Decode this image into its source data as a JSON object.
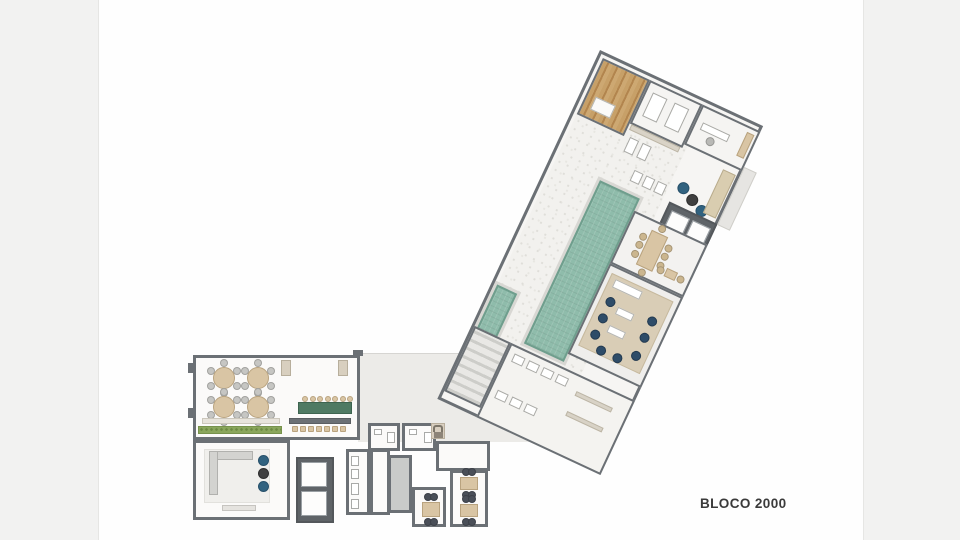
{
  "label": {
    "text": "BLOCO 2000"
  },
  "palette": {
    "wall": "#6b7075",
    "wall_dark": "#5f6468",
    "floor": "#fbfaf9",
    "floor_gray": "#ecebe8",
    "deck": "#f2f1ee",
    "pool": "#8fbcab",
    "pool_edge": "#6f9e8d",
    "wood_deck": "#c7a068",
    "furniture_beige": "#d9c5a4",
    "communal_table_green": "#4f7a63",
    "hedge_green": "#8aa65c",
    "navy_chair": "#2e4c68",
    "pouf_blue": "#31627f",
    "tree_green": "#4c7d46",
    "rug_tan": "#d9cdb6"
  },
  "furniture": [
    {
      "kind": "round-table",
      "parent": "party-room",
      "name": "dining-table-round",
      "cx": 28,
      "cy": 20,
      "r": 11,
      "chairs": 6
    },
    {
      "kind": "round-table",
      "parent": "party-room",
      "name": "dining-table-round",
      "cx": 62,
      "cy": 20,
      "r": 11,
      "chairs": 6
    },
    {
      "kind": "round-table",
      "parent": "party-room",
      "name": "dining-table-round",
      "cx": 28,
      "cy": 49,
      "r": 11,
      "chairs": 6
    },
    {
      "kind": "round-table",
      "parent": "party-room",
      "name": "dining-table-round",
      "cx": 62,
      "cy": 49,
      "r": 11,
      "chairs": 6
    },
    {
      "kind": "box",
      "parent": "party-room",
      "name": "bench",
      "x": 85,
      "y": 2,
      "w": 10,
      "h": 16,
      "fill": "#d8cfbf",
      "stroke": "#b7ae9c"
    },
    {
      "kind": "box",
      "parent": "party-room",
      "name": "bench",
      "x": 142,
      "y": 2,
      "w": 10,
      "h": 16,
      "fill": "#d8cfbf",
      "stroke": "#b7ae9c"
    },
    {
      "kind": "box",
      "parent": "party-room",
      "name": "bench-row",
      "x": 6,
      "y": 60,
      "w": 78,
      "h": 6,
      "fill": "#e8e4dc",
      "stroke": "#ccc7bc"
    },
    {
      "kind": "hedge",
      "parent": "party-room",
      "name": "planter-hedge",
      "x": 2,
      "y": 68,
      "w": 84,
      "h": 8
    },
    {
      "kind": "box",
      "parent": "party-room",
      "name": "communal-table",
      "x": 102,
      "y": 44,
      "w": 54,
      "h": 12,
      "fill": "#4f7a63",
      "stroke": "#3e6450"
    },
    {
      "kind": "row",
      "parent": "party-room",
      "name": "stool",
      "shape": "circle",
      "x": 106,
      "y": 38,
      "dx": 7.5,
      "dy": 0,
      "n": 7,
      "size": 6,
      "fill": "#d9c5a4",
      "stroke": "#b9a37f"
    },
    {
      "kind": "box",
      "parent": "party-room",
      "name": "bar-counter",
      "x": 93,
      "y": 60,
      "w": 62,
      "h": 6,
      "fill": "#6b7075",
      "stroke": "#5a5e62"
    },
    {
      "kind": "row",
      "parent": "party-room",
      "name": "bar-stool",
      "shape": "square",
      "x": 96,
      "y": 68,
      "dx": 8,
      "dy": 0,
      "n": 7,
      "size": 6,
      "fill": "#d9c5a4",
      "stroke": "#b9a37f"
    },
    {
      "kind": "box",
      "parent": "lounge-room",
      "name": "rug",
      "x": 8,
      "y": 6,
      "w": 66,
      "h": 54,
      "fill": "#f0efec",
      "stroke": "#e2e1dd"
    },
    {
      "kind": "box",
      "parent": "lounge-room",
      "name": "sofa",
      "x": 13,
      "y": 8,
      "w": 44,
      "h": 9,
      "fill": "#d3d3d0",
      "stroke": "#b1b1ae"
    },
    {
      "kind": "box",
      "parent": "lounge-room",
      "name": "sofa",
      "x": 13,
      "y": 8,
      "w": 9,
      "h": 44,
      "fill": "#d3d3d0",
      "stroke": "#b1b1ae"
    },
    {
      "kind": "circle",
      "parent": "lounge-room",
      "name": "pouf",
      "x": 62,
      "y": 12,
      "w": 11,
      "h": 11,
      "fill": "#31627f",
      "stroke": "#27506a"
    },
    {
      "kind": "circle",
      "parent": "lounge-room",
      "name": "pouf",
      "x": 62,
      "y": 25,
      "w": 11,
      "h": 11,
      "fill": "#3f3f3f",
      "stroke": "#2e2e2e"
    },
    {
      "kind": "circle",
      "parent": "lounge-room",
      "name": "pouf",
      "x": 62,
      "y": 38,
      "w": 11,
      "h": 11,
      "fill": "#31627f",
      "stroke": "#27506a"
    },
    {
      "kind": "box",
      "parent": "lounge-room",
      "name": "tv-console",
      "x": 26,
      "y": 62,
      "w": 34,
      "h": 6,
      "fill": "#e5e3df",
      "stroke": "#c6c4c0"
    },
    {
      "kind": "box",
      "parent": "elevator-a",
      "name": "elevator-car",
      "x": 3,
      "y": 3,
      "w": 26,
      "h": 25,
      "fill": "#fdfdfc",
      "stroke": "#9aa0a4"
    },
    {
      "kind": "box",
      "parent": "elevator-a",
      "name": "elevator-car",
      "x": 3,
      "y": 32,
      "w": 26,
      "h": 25,
      "fill": "#fdfdfc",
      "stroke": "#9aa0a4"
    },
    {
      "kind": "box",
      "parent": "kitchen",
      "name": "appliance",
      "x": 2,
      "y": 4,
      "w": 8,
      "h": 10,
      "fill": "#ffffff",
      "stroke": "#a9aaa8"
    },
    {
      "kind": "box",
      "parent": "kitchen",
      "name": "appliance",
      "x": 2,
      "y": 17,
      "w": 8,
      "h": 10,
      "fill": "#ffffff",
      "stroke": "#a9aaa8"
    },
    {
      "kind": "box",
      "parent": "kitchen",
      "name": "sink",
      "x": 2,
      "y": 31,
      "w": 8,
      "h": 12,
      "fill": "#ffffff",
      "stroke": "#a9aaa8"
    },
    {
      "kind": "box",
      "parent": "kitchen",
      "name": "stove",
      "x": 2,
      "y": 47,
      "w": 8,
      "h": 10,
      "fill": "#ffffff",
      "stroke": "#a9aaa8"
    },
    {
      "kind": "box",
      "parent": "wc-1",
      "name": "sink",
      "x": 3,
      "y": 3,
      "w": 8,
      "h": 6,
      "fill": "#ffffff",
      "stroke": "#a9aaa8"
    },
    {
      "kind": "box",
      "parent": "wc-1",
      "name": "toilet",
      "x": 16,
      "y": 6,
      "w": 8,
      "h": 11,
      "fill": "#ffffff",
      "stroke": "#a9aaa8"
    },
    {
      "kind": "box",
      "parent": "wc-2",
      "name": "sink",
      "x": 4,
      "y": 3,
      "w": 8,
      "h": 6,
      "fill": "#ffffff",
      "stroke": "#a9aaa8"
    },
    {
      "kind": "box",
      "parent": "wc-2",
      "name": "toilet",
      "x": 19,
      "y": 6,
      "w": 8,
      "h": 11,
      "fill": "#ffffff",
      "stroke": "#a9aaa8"
    },
    {
      "kind": "rect-table",
      "parent": "breakfast-room",
      "name": "breakfast-table",
      "x": 7,
      "y": 12,
      "w": 18,
      "h": 15,
      "fill": "#d9c5a4",
      "stroke": "#b9a37f",
      "sides": {
        "t": 2,
        "b": 2
      },
      "chairFill": "#4a4f58"
    },
    {
      "kind": "rect-table",
      "parent": "games-room",
      "name": "games-table",
      "x": 7,
      "y": 4,
      "w": 18,
      "h": 13,
      "fill": "#d9c5a4",
      "stroke": "#b9a37f",
      "sides": {
        "t": 2,
        "b": 2
      },
      "chairFill": "#4a4f58"
    },
    {
      "kind": "rect-table",
      "parent": "games-room",
      "name": "games-table",
      "x": 7,
      "y": 31,
      "w": 18,
      "h": 13,
      "fill": "#d9c5a4",
      "stroke": "#b9a37f",
      "sides": {
        "t": 2,
        "b": 2
      },
      "chairFill": "#4a4f58"
    },
    {
      "kind": "box",
      "parent": "sauna-room",
      "name": "sauna-bench",
      "x": 8,
      "y": 36,
      "w": 22,
      "h": 14,
      "fill": "#fbfaf8",
      "stroke": "#b5b5b0"
    },
    {
      "kind": "box",
      "parent": "massage-room",
      "name": "massage-bed",
      "x": 6,
      "y": 8,
      "w": 16,
      "h": 26,
      "fill": "#ffffff",
      "stroke": "#a9a9a5"
    },
    {
      "kind": "box",
      "parent": "massage-room",
      "name": "massage-bed",
      "x": 30,
      "y": 8,
      "w": 16,
      "h": 26,
      "fill": "#ffffff",
      "stroke": "#a9a9a5"
    },
    {
      "kind": "box",
      "parent": "office",
      "name": "desk",
      "x": 6,
      "y": 14,
      "w": 30,
      "h": 8,
      "fill": "#ffffff",
      "stroke": "#a9a9a5"
    },
    {
      "kind": "circle",
      "parent": "office",
      "name": "office-chair",
      "x": 16,
      "y": 24,
      "w": 9,
      "h": 9,
      "fill": "#b9b9b6",
      "stroke": "#989895"
    },
    {
      "kind": "box",
      "parent": "office",
      "name": "sideboard",
      "x": 50,
      "y": 4,
      "w": 8,
      "h": 26,
      "fill": "#d9c5a4",
      "stroke": "#b9a37f"
    },
    {
      "kind": "box",
      "parent": "lobby",
      "name": "shelf",
      "x": 2,
      "y": 0,
      "w": 54,
      "h": 6,
      "fill": "#d9d3c7",
      "stroke": "#bcb5a5"
    },
    {
      "kind": "box",
      "parent": "lobby",
      "name": "gym-equipment",
      "x": 6,
      "y": 12,
      "w": 10,
      "h": 16,
      "fill": "#ffffff",
      "stroke": "#a9a9a5"
    },
    {
      "kind": "box",
      "parent": "lobby",
      "name": "gym-equipment",
      "x": 20,
      "y": 12,
      "w": 10,
      "h": 16,
      "fill": "#ffffff",
      "stroke": "#a9a9a5"
    },
    {
      "kind": "box",
      "parent": "lobby",
      "name": "gym-equipment",
      "x": 24,
      "y": 40,
      "w": 10,
      "h": 12,
      "fill": "#ffffff",
      "stroke": "#a9a9a5"
    },
    {
      "kind": "box",
      "parent": "lobby",
      "name": "gym-equipment",
      "x": 37,
      "y": 40,
      "w": 10,
      "h": 12,
      "fill": "#ffffff",
      "stroke": "#a9a9a5"
    },
    {
      "kind": "box",
      "parent": "lobby",
      "name": "gym-equipment",
      "x": 50,
      "y": 40,
      "w": 10,
      "h": 12,
      "fill": "#ffffff",
      "stroke": "#a9a9a5"
    },
    {
      "kind": "circle",
      "parent": "lobby",
      "name": "pouf",
      "x": 70,
      "y": 30,
      "w": 12,
      "h": 12,
      "fill": "#31627f",
      "stroke": "#27506a"
    },
    {
      "kind": "circle",
      "parent": "lobby",
      "name": "pouf",
      "x": 83,
      "y": 37,
      "w": 12,
      "h": 12,
      "fill": "#3f3f3f",
      "stroke": "#2e2e2e"
    },
    {
      "kind": "circle",
      "parent": "lobby",
      "name": "pouf",
      "x": 96,
      "y": 43,
      "w": 12,
      "h": 12,
      "fill": "#31627f",
      "stroke": "#27506a"
    },
    {
      "kind": "box",
      "parent": "lobby",
      "name": "planter-bench",
      "x": 104,
      "y": 2,
      "w": 14,
      "h": 48,
      "fill": "#d9cdb0",
      "stroke": "#b8ab8c"
    },
    {
      "kind": "box",
      "parent": "elevator-b",
      "name": "elevator-car",
      "x": 4,
      "y": 5,
      "w": 20,
      "h": 46,
      "fill": "#fdfdfc",
      "stroke": "#9aa0a4"
    },
    {
      "kind": "box",
      "parent": "elevator-b",
      "name": "elevator-car",
      "x": 27,
      "y": 5,
      "w": 20,
      "h": 46,
      "fill": "#fdfdfc",
      "stroke": "#9aa0a4"
    },
    {
      "kind": "box",
      "parent": "deck",
      "name": "sun-lounger",
      "x": 4,
      "y": 18,
      "w": 26,
      "h": 16,
      "fill": "#fdfdfc",
      "stroke": "#b5b5b1"
    },
    {
      "kind": "box",
      "parent": "deck",
      "name": "sun-lounger",
      "x": 4,
      "y": 40,
      "w": 26,
      "h": 16,
      "fill": "#fdfdfc",
      "stroke": "#b5b5b1"
    },
    {
      "kind": "box",
      "parent": "deck",
      "name": "sun-lounger",
      "x": 4,
      "y": 62,
      "w": 26,
      "h": 16,
      "fill": "#fdfdfc",
      "stroke": "#b5b5b1"
    },
    {
      "kind": "box",
      "parent": "deck",
      "name": "sun-lounger",
      "x": 4,
      "y": 84,
      "w": 26,
      "h": 16,
      "fill": "#fdfdfc",
      "stroke": "#b5b5b1"
    },
    {
      "kind": "box",
      "parent": "deck",
      "name": "sun-lounger",
      "x": 4,
      "y": 132,
      "w": 26,
      "h": 16,
      "fill": "#fdfdfc",
      "stroke": "#b5b5b1"
    },
    {
      "kind": "box",
      "parent": "deck",
      "name": "sun-lounger",
      "x": 4,
      "y": 154,
      "w": 26,
      "h": 16,
      "fill": "#fdfdfc",
      "stroke": "#b5b5b1"
    },
    {
      "kind": "box",
      "parent": "deck",
      "name": "sun-lounger",
      "x": 4,
      "y": 176,
      "w": 26,
      "h": 16,
      "fill": "#fdfdfc",
      "stroke": "#b5b5b1"
    },
    {
      "kind": "box",
      "parent": "deck",
      "name": "sun-lounger",
      "x": 4,
      "y": 198,
      "w": 26,
      "h": 16,
      "fill": "#fdfdfc",
      "stroke": "#b5b5b1"
    },
    {
      "kind": "box",
      "parent": "deck",
      "name": "side-table",
      "x": 32,
      "y": 26,
      "w": 6,
      "h": 6,
      "fill": "#5a5e62",
      "stroke": "#4a4e52"
    },
    {
      "kind": "box",
      "parent": "deck",
      "name": "side-table",
      "x": 32,
      "y": 70,
      "w": 6,
      "h": 6,
      "fill": "#5a5e62",
      "stroke": "#4a4e52"
    },
    {
      "kind": "box",
      "parent": "deck",
      "name": "side-table",
      "x": 32,
      "y": 140,
      "w": 6,
      "h": 6,
      "fill": "#5a5e62",
      "stroke": "#4a4e52"
    },
    {
      "kind": "box",
      "parent": "deck",
      "name": "side-table",
      "x": 32,
      "y": 184,
      "w": 6,
      "h": 6,
      "fill": "#5a5e62",
      "stroke": "#4a4e52"
    },
    {
      "kind": "tree",
      "parent": "deck",
      "name": "tree-icon",
      "x": 15,
      "y": 123,
      "w": 18
    },
    {
      "kind": "tree",
      "parent": "deck",
      "name": "tree-icon",
      "x": 7,
      "y": 186,
      "w": 18
    },
    {
      "kind": "rect-table",
      "parent": "dining-room",
      "name": "dining-table-long",
      "x": 22,
      "y": 8,
      "w": 18,
      "h": 38,
      "fill": "#d9c5a4",
      "stroke": "#b9a37f",
      "sides": {
        "l": 3,
        "r": 3,
        "t": 1,
        "b": 1
      },
      "chairFill": "#cbb68f"
    },
    {
      "kind": "rect-table",
      "parent": "dining-room",
      "name": "cafe-table",
      "x": 52,
      "y": 36,
      "w": 12,
      "h": 9,
      "fill": "#d9c5a4",
      "stroke": "#b9a37f",
      "sides": {
        "l": 1,
        "r": 1
      },
      "chairFill": "#cbb68f"
    },
    {
      "kind": "box",
      "parent": "lounge-area",
      "name": "rug",
      "x": 4,
      "y": 6,
      "w": 68,
      "h": 80,
      "fill": "#d9cdb6",
      "stroke": "#c6b99e"
    },
    {
      "kind": "box",
      "parent": "lounge-area",
      "name": "island",
      "x": 10,
      "y": 10,
      "w": 30,
      "h": 9,
      "fill": "#ffffff",
      "stroke": "#b5b5b1"
    },
    {
      "kind": "box",
      "parent": "lounge-area",
      "name": "coffee-table",
      "x": 24,
      "y": 34,
      "w": 18,
      "h": 8,
      "fill": "#ffffff",
      "stroke": "#b5b5b1"
    },
    {
      "kind": "box",
      "parent": "lounge-area",
      "name": "coffee-table",
      "x": 24,
      "y": 54,
      "w": 18,
      "h": 8,
      "fill": "#ffffff",
      "stroke": "#b5b5b1"
    },
    {
      "kind": "circle",
      "parent": "lounge-area",
      "name": "lounge-chair",
      "x": 10,
      "y": 28,
      "w": 10,
      "h": 10,
      "fill": "#2e4c68",
      "stroke": "#233a50"
    },
    {
      "kind": "circle",
      "parent": "lounge-area",
      "name": "lounge-chair",
      "x": 10,
      "y": 46,
      "w": 10,
      "h": 10,
      "fill": "#2e4c68",
      "stroke": "#233a50"
    },
    {
      "kind": "circle",
      "parent": "lounge-area",
      "name": "lounge-chair",
      "x": 10,
      "y": 64,
      "w": 10,
      "h": 10,
      "fill": "#2e4c68",
      "stroke": "#233a50"
    },
    {
      "kind": "circle",
      "parent": "lounge-area",
      "name": "lounge-chair",
      "x": 22,
      "y": 76,
      "w": 10,
      "h": 10,
      "fill": "#2e4c68",
      "stroke": "#233a50"
    },
    {
      "kind": "circle",
      "parent": "lounge-area",
      "name": "lounge-chair",
      "x": 40,
      "y": 76,
      "w": 10,
      "h": 10,
      "fill": "#2e4c68",
      "stroke": "#233a50"
    },
    {
      "kind": "circle",
      "parent": "lounge-area",
      "name": "lounge-chair",
      "x": 56,
      "y": 66,
      "w": 10,
      "h": 10,
      "fill": "#2e4c68",
      "stroke": "#233a50"
    },
    {
      "kind": "circle",
      "parent": "lounge-area",
      "name": "lounge-chair",
      "x": 56,
      "y": 46,
      "w": 10,
      "h": 10,
      "fill": "#2e4c68",
      "stroke": "#233a50"
    },
    {
      "kind": "circle",
      "parent": "lounge-area",
      "name": "lounge-chair",
      "x": 56,
      "y": 28,
      "w": 10,
      "h": 10,
      "fill": "#2e4c68",
      "stroke": "#233a50"
    },
    {
      "kind": "box",
      "parent": "changing-rooms",
      "name": "shower-stall",
      "x": 6,
      "y": 6,
      "w": 12,
      "h": 9,
      "fill": "#ffffff",
      "stroke": "#a9a9a5"
    },
    {
      "kind": "box",
      "parent": "changing-rooms",
      "name": "shower-stall",
      "x": 22,
      "y": 6,
      "w": 12,
      "h": 9,
      "fill": "#ffffff",
      "stroke": "#a9a9a5"
    },
    {
      "kind": "box",
      "parent": "changing-rooms",
      "name": "shower-stall",
      "x": 38,
      "y": 6,
      "w": 12,
      "h": 9,
      "fill": "#ffffff",
      "stroke": "#a9a9a5"
    },
    {
      "kind": "box",
      "parent": "changing-rooms",
      "name": "shower-stall",
      "x": 54,
      "y": 6,
      "w": 12,
      "h": 9,
      "fill": "#ffffff",
      "stroke": "#a9a9a5"
    },
    {
      "kind": "box",
      "parent": "changing-rooms",
      "name": "locker-bench",
      "x": 78,
      "y": 14,
      "w": 40,
      "h": 5,
      "fill": "#d8d2c6",
      "stroke": "#bcb5a5"
    },
    {
      "kind": "box",
      "parent": "changing-rooms",
      "name": "shower-stall",
      "x": 6,
      "y": 46,
      "w": 12,
      "h": 9,
      "fill": "#ffffff",
      "stroke": "#a9a9a5"
    },
    {
      "kind": "box",
      "parent": "changing-rooms",
      "name": "shower-stall",
      "x": 22,
      "y": 46,
      "w": 12,
      "h": 9,
      "fill": "#ffffff",
      "stroke": "#a9a9a5"
    },
    {
      "kind": "box",
      "parent": "changing-rooms",
      "name": "shower-stall",
      "x": 38,
      "y": 46,
      "w": 12,
      "h": 9,
      "fill": "#ffffff",
      "stroke": "#a9a9a5"
    },
    {
      "kind": "box",
      "parent": "changing-rooms",
      "name": "locker-bench",
      "x": 78,
      "y": 36,
      "w": 40,
      "h": 5,
      "fill": "#d8d2c6",
      "stroke": "#bcb5a5"
    }
  ]
}
